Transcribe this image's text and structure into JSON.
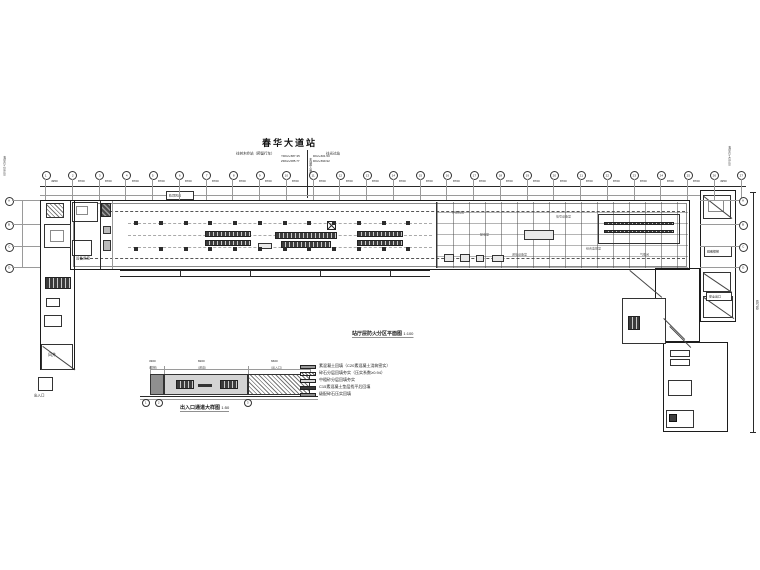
{
  "colors": {
    "paper": "#ffffff",
    "ink": "#1a1a1a",
    "wall": "#222222",
    "light_line": "#9a9a9a",
    "fill_dark": "#3f3f3f"
  },
  "header": {
    "station_title": "春华大道站",
    "left_direction": "往树木岭站（预留行车）",
    "right_direction": "往光达站",
    "mileage_left_line1": "YDK2+587.35",
    "mileage_left_line2": "ZDK2+585.77",
    "mileage_right_line1": "DK2+601.50",
    "mileage_right_line2": "DK2+599.92",
    "center_mileage_vertical": "车站中心里程"
  },
  "grid": {
    "top_axes": [
      "1",
      "2",
      "3",
      "4",
      "5",
      "6",
      "7",
      "8",
      "9",
      "10",
      "11",
      "12",
      "13",
      "14",
      "15",
      "16",
      "17",
      "18",
      "19",
      "20",
      "21",
      "22",
      "23",
      "24",
      "25",
      "26",
      "27"
    ],
    "bay_dims": [
      "4950",
      "8700",
      "8700",
      "8700",
      "8700",
      "8700",
      "8700",
      "8700",
      "8700",
      "8700",
      "8700",
      "8700",
      "8700",
      "8700",
      "8700",
      "8700",
      "8700",
      "8700",
      "8700",
      "8700",
      "8700",
      "8700",
      "8700",
      "8700",
      "8700",
      "4950"
    ],
    "left_axes": [
      "A",
      "B",
      "C",
      "D"
    ],
    "right_axes": [
      "A",
      "B",
      "C",
      "D"
    ],
    "left_edge_mileage": "右DK2+158.00",
    "right_edge_mileage": "右DK2+425.00",
    "right_total_dim": "65700"
  },
  "plan": {
    "caption": "站厅层防火分区平面图",
    "caption_scale": "1:100",
    "top_note": "轨顶风道",
    "left_room_label": "设备用房",
    "shaft_label": "风井",
    "entrance_label": "出入口",
    "stair_label": "疏散楼梯",
    "exit_label": "安全出口",
    "room_labels": [
      "环控机房",
      "配电室",
      "通信设备室",
      "信号设备室",
      "综合监控室",
      "气瓶间"
    ]
  },
  "detail": {
    "caption": "出入口通道大样图",
    "scale": "1:50",
    "dims": [
      "3300",
      "8200",
      "6600"
    ],
    "dim_notes": [
      "(楼梯)",
      "(通道)",
      "(出入口)"
    ],
    "axes": [
      "1",
      "2",
      "3"
    ]
  },
  "legend": {
    "items": [
      {
        "swatch": "solid-gray",
        "label": "素混凝土回填（C20素混凝土浇筑密实）"
      },
      {
        "swatch": "hatch",
        "label": "碎石分层回填夯实（压实系数≥0.94）"
      },
      {
        "swatch": "light",
        "label": "中粗砂分层回填夯实"
      },
      {
        "swatch": "dark",
        "label": "C15素混凝土垫层找平后回填"
      },
      {
        "swatch": "mid",
        "label": "级配碎石压实回填"
      }
    ]
  }
}
